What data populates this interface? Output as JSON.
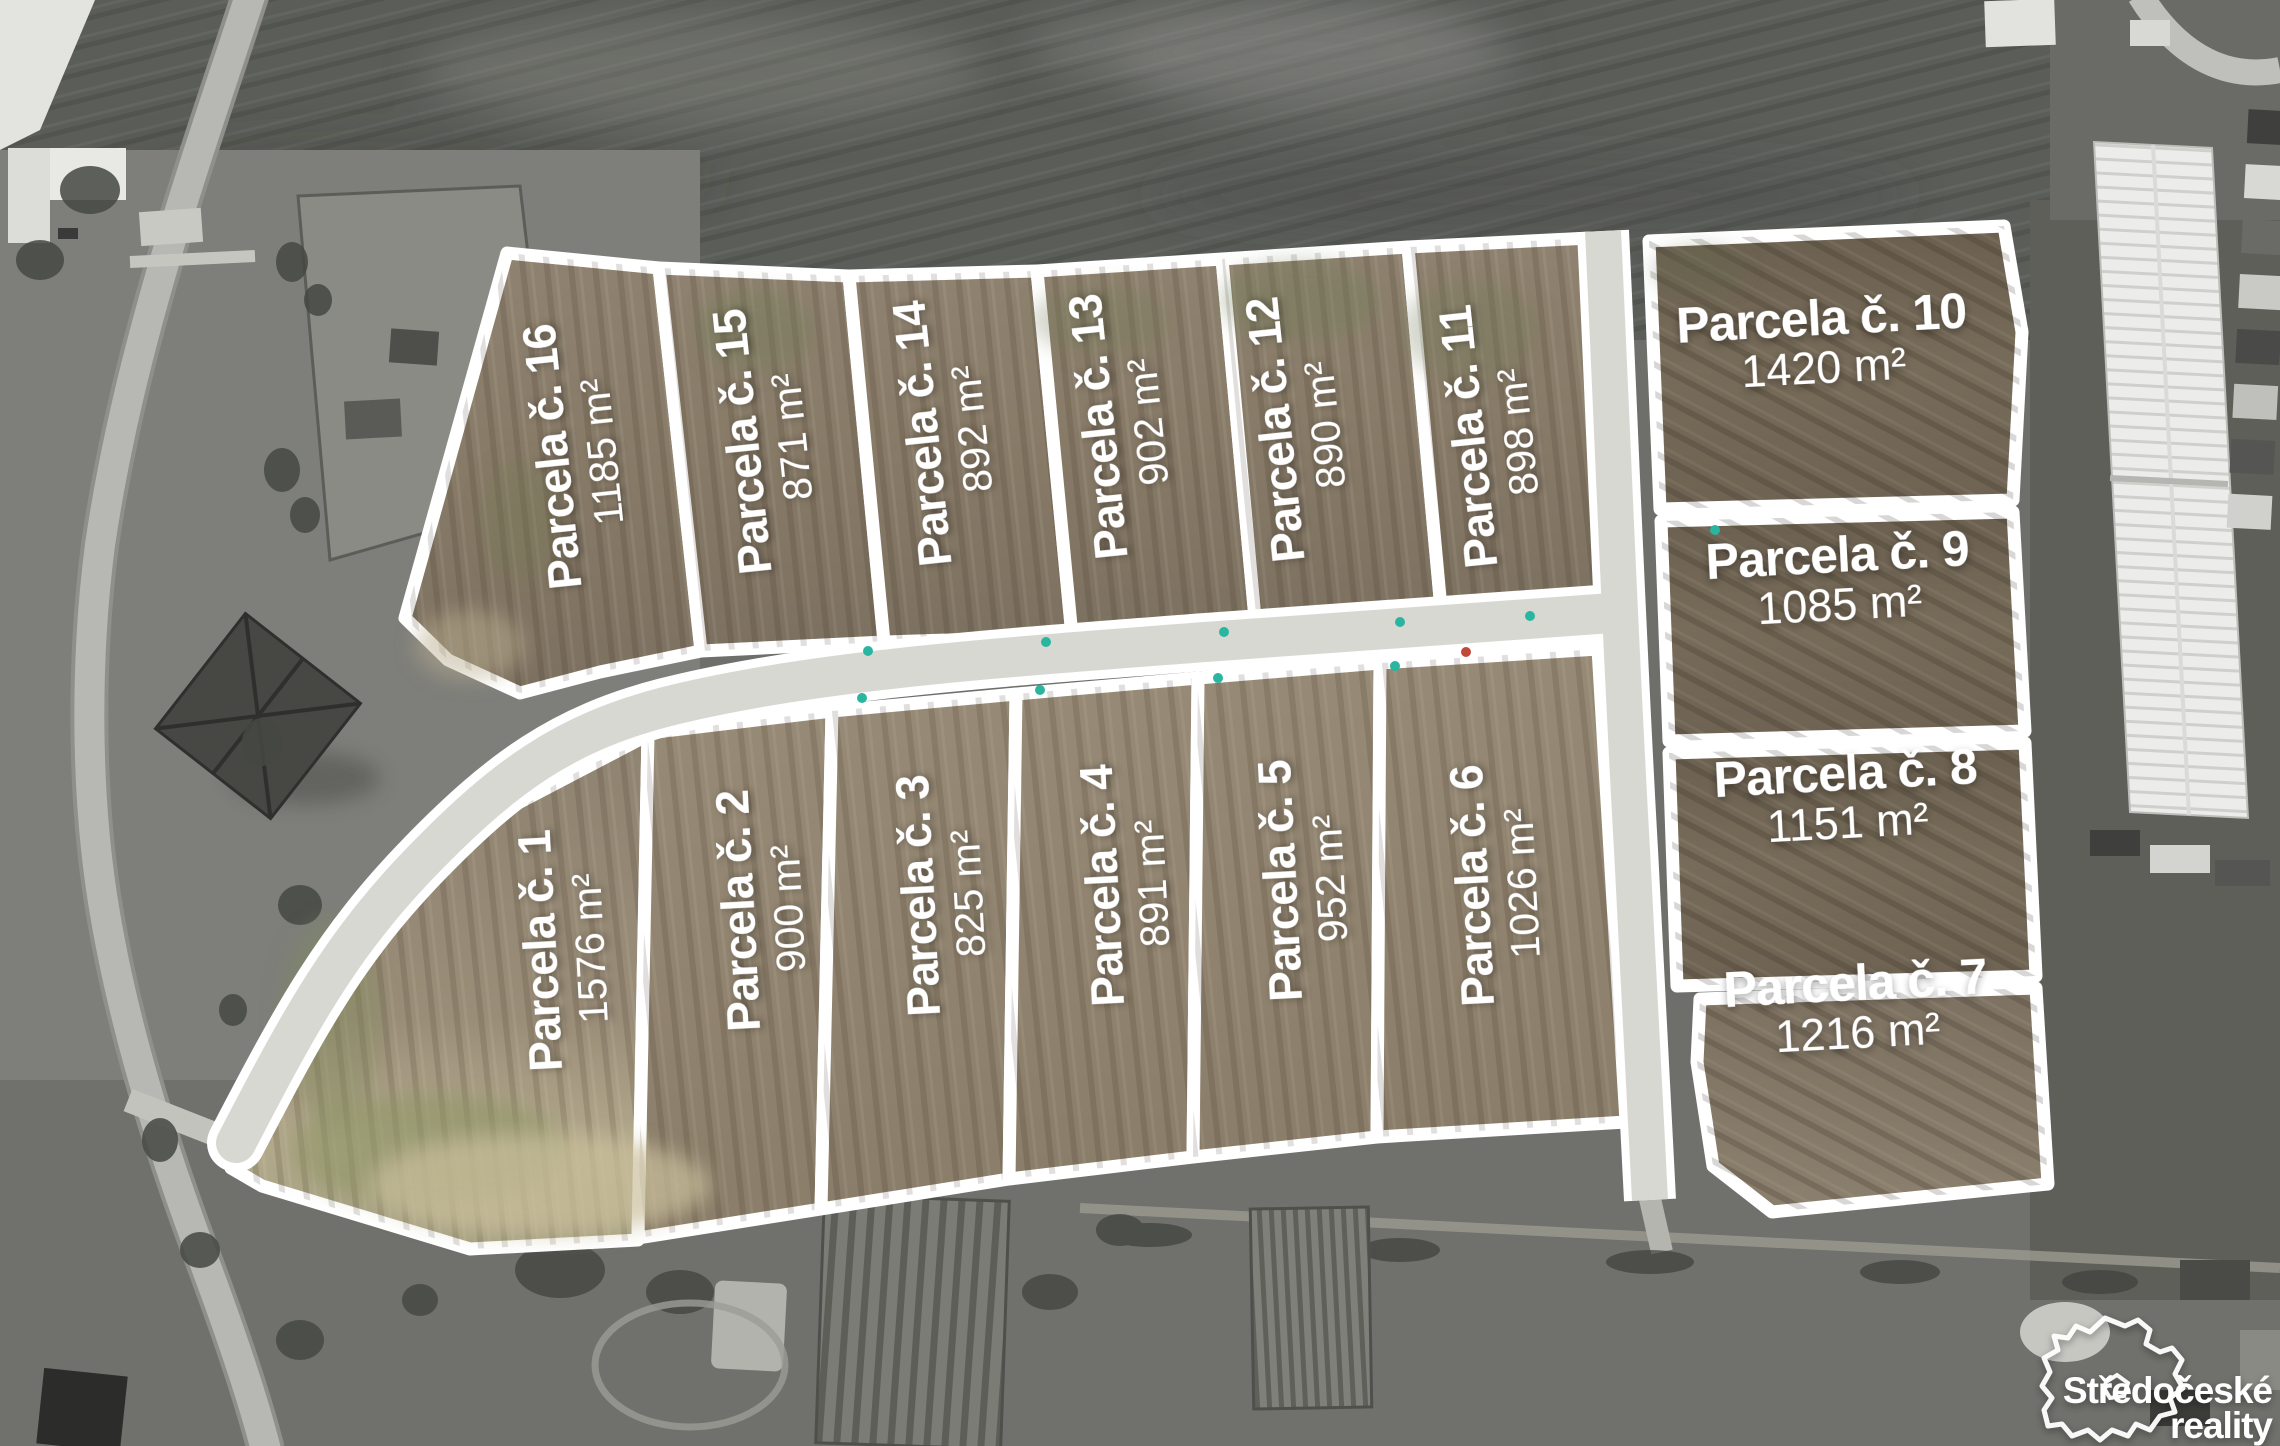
{
  "parcels": {
    "p1": {
      "name": "Parcela č. 1",
      "area": "1576 m²"
    },
    "p2": {
      "name": "Parcela č. 2",
      "area": "900 m²"
    },
    "p3": {
      "name": "Parcela č. 3",
      "area": "825 m²"
    },
    "p4": {
      "name": "Parcela č. 4",
      "area": "891 m²"
    },
    "p5": {
      "name": "Parcela č. 5",
      "area": "952 m²"
    },
    "p6": {
      "name": "Parcela č. 6",
      "area": "1026 m²"
    },
    "p7": {
      "name": "Parcela č. 7",
      "area": "1216 m²"
    },
    "p8": {
      "name": "Parcela č. 8",
      "area": "1151 m²"
    },
    "p9": {
      "name": "Parcela č. 9",
      "area": "1085 m²"
    },
    "p10": {
      "name": "Parcela č. 10",
      "area": "1420 m²"
    },
    "p11": {
      "name": "Parcela č. 11",
      "area": "898 m²"
    },
    "p12": {
      "name": "Parcela č. 12",
      "area": "890 m²"
    },
    "p13": {
      "name": "Parcela č. 13",
      "area": "902 m²"
    },
    "p14": {
      "name": "Parcela č. 14",
      "area": "892 m²"
    },
    "p15": {
      "name": "Parcela č. 15",
      "area": "871 m²"
    },
    "p16": {
      "name": "Parcela č. 16",
      "area": "1185 m²"
    }
  },
  "logo": {
    "line1": "Středočeské",
    "line2": "reality"
  },
  "colors": {
    "outline": "#ffffff",
    "road_surface": "#d8d8d3",
    "soil_top": "#877a67",
    "soil_bottom": "#8f8270",
    "soil_right": "#736756",
    "marker_teal": "#2ab5a0"
  }
}
